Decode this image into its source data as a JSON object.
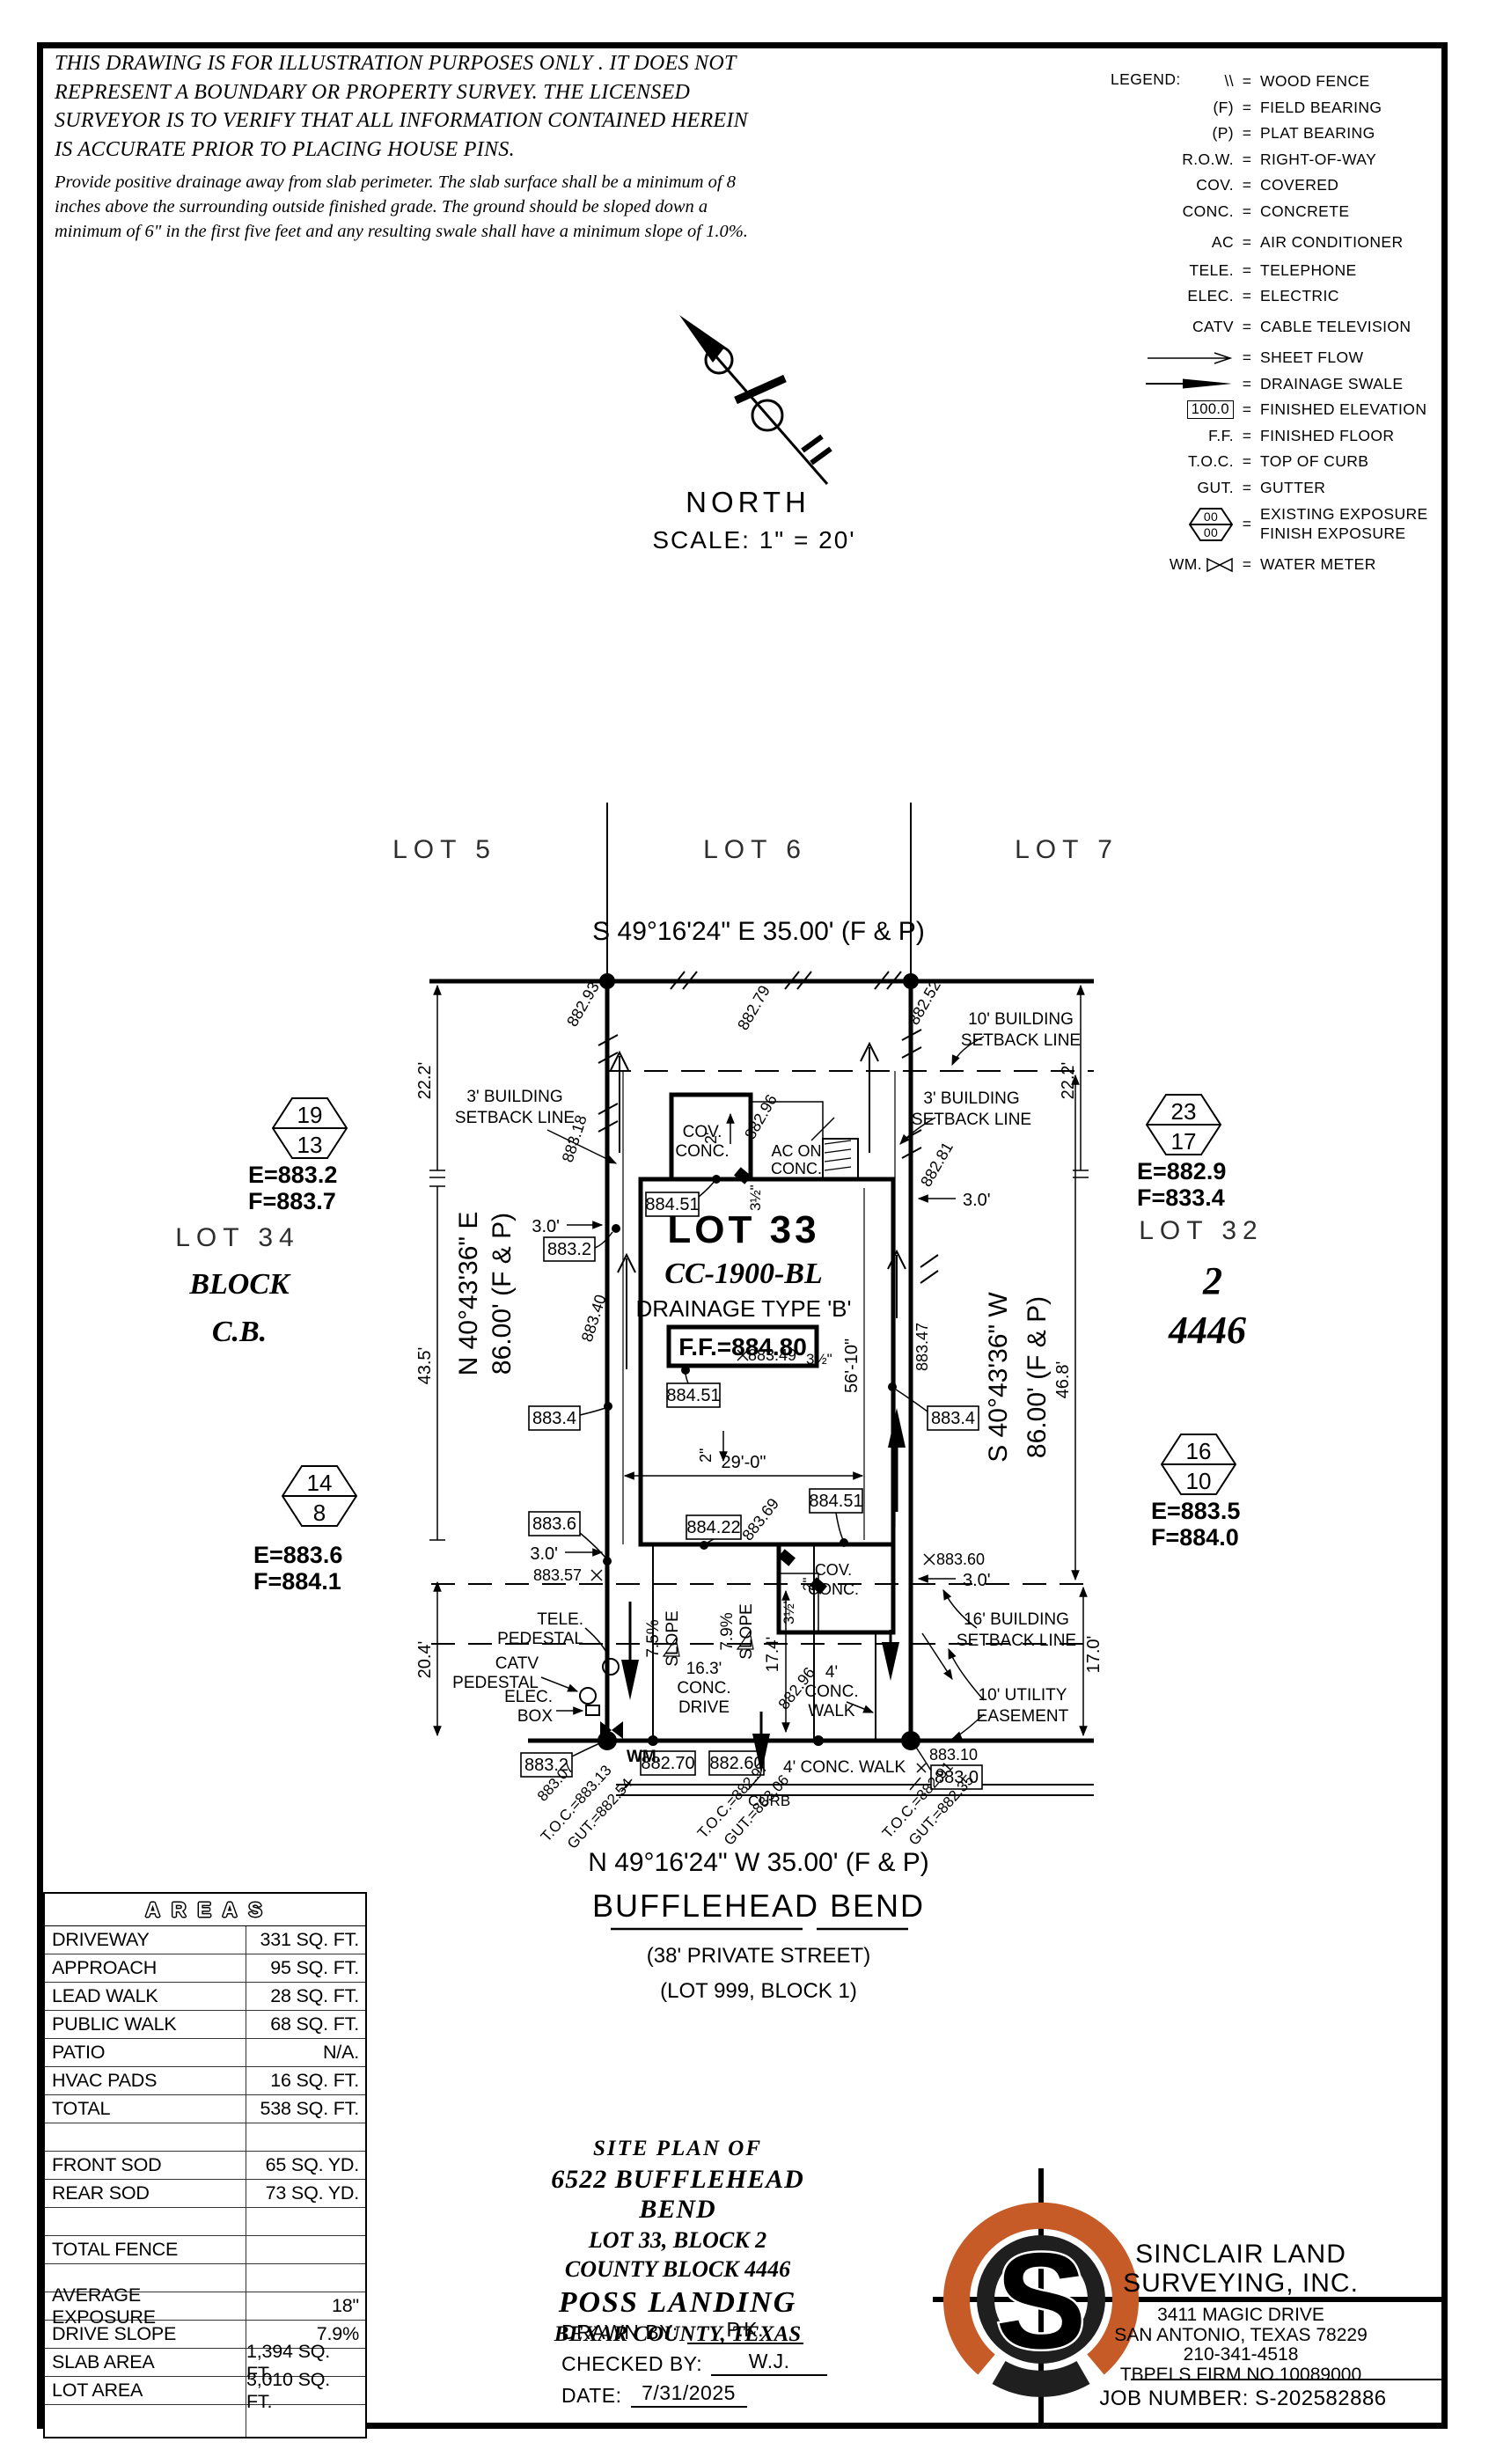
{
  "colors": {
    "ink": "#000000",
    "logo_orange": "#C75B28",
    "logo_dark": "#1f1f1f"
  },
  "disclaimer": {
    "p1": "THIS DRAWING IS FOR ILLUSTRATION PURPOSES ONLY . IT DOES NOT REPRESENT A BOUNDARY OR PROPERTY SURVEY. THE LICENSED SURVEYOR IS TO VERIFY THAT ALL INFORMATION CONTAINED HEREIN IS ACCURATE PRIOR TO PLACING HOUSE PINS.",
    "p2": "Provide positive drainage away from slab perimeter. The slab surface shall be a minimum of 8 inches above the surrounding outside finished grade. The ground should be sloped down a minimum of 6\" in the first five feet and any resulting swale shall have a minimum slope of 1.0%."
  },
  "legend": {
    "title": "LEGEND:",
    "eq": "=",
    "hex_top": "00",
    "hex_bottom": "00",
    "wm_box": "100.0",
    "items": [
      {
        "sym": "\\\\",
        "label": "WOOD FENCE"
      },
      {
        "sym": "(F)",
        "label": "FIELD BEARING"
      },
      {
        "sym": "(P)",
        "label": "PLAT BEARING"
      },
      {
        "sym": "R.O.W.",
        "label": "RIGHT-OF-WAY"
      },
      {
        "sym": "COV.",
        "label": "COVERED"
      },
      {
        "sym": "CONC.",
        "label": "CONCRETE"
      },
      {
        "sym": "AC",
        "label": "AIR CONDITIONER"
      },
      {
        "sym": "TELE.",
        "label": "TELEPHONE"
      },
      {
        "sym": "ELEC.",
        "label": "ELECTRIC"
      },
      {
        "sym": "CATV",
        "label": "CABLE TELEVISION"
      },
      {
        "sym": "sheet-flow-arrow",
        "label": "SHEET FLOW"
      },
      {
        "sym": "drainage-swale-arrow",
        "label": "DRAINAGE SWALE"
      },
      {
        "sym": "100.0",
        "label": "FINISHED ELEVATION"
      },
      {
        "sym": "F.F.",
        "label": "FINISHED FLOOR"
      },
      {
        "sym": "T.O.C.",
        "label": "TOP OF CURB"
      },
      {
        "sym": "GUT.",
        "label": "GUTTER"
      },
      {
        "sym": "exposure-hexagon",
        "label": "EXISTING EXPOSURE",
        "label2": "FINISH EXPOSURE"
      },
      {
        "sym": "WM.",
        "label": "WATER METER"
      }
    ]
  },
  "north": {
    "label": "NORTH",
    "scale": "SCALE: 1\" = 20'"
  },
  "plat": {
    "lots": {
      "lot5": "LOT 5",
      "lot6": "LOT 6",
      "lot7": "LOT 7",
      "lot34": "LOT 34",
      "block": "BLOCK",
      "cb": "C.B.",
      "lot32": "LOT 32",
      "block_num": "2",
      "county_block": "4446"
    },
    "bearings": {
      "top": "S 49°16'24\" E 35.00' (F & P)",
      "bottom": "N 49°16'24\" W 35.00' (F & P)",
      "left1": "N 40°43'36\" E",
      "left2": "86.00' (F & P)",
      "right1": "S 40°43'36\" W",
      "right2": "86.00' (F & P)"
    },
    "street": {
      "name": "BUFFLEHEAD BEND",
      "note1": "(38' PRIVATE STREET)",
      "note2": "(LOT 999, BLOCK 1)",
      "curb": "CURB"
    },
    "house": {
      "lot33": "LOT 33",
      "plan": "CC-1900-BL",
      "drainage": "DRAINAGE TYPE 'B'",
      "ff": "F.F.=884.80"
    },
    "setbacks": {
      "b10a": "10' BUILDING",
      "b10b": "SETBACK LINE",
      "b3a": "3' BUILDING",
      "b3b": "SETBACK LINE",
      "b16a": "16' BUILDING",
      "b16b": "SETBACK LINE",
      "uea": "10' UTILITY",
      "ueb": "EASEMENT"
    },
    "features": {
      "cova": "COV.",
      "covb": "CONC.",
      "aca": "AC ON",
      "acb": "CONC.",
      "drv1": "16.3'",
      "drv2": "CONC.",
      "drv3": "DRIVE",
      "slope75": "7.5%",
      "slope79": "7.9%",
      "slope_word": "SLOPE",
      "walk1": "4'",
      "walk2": "CONC.",
      "walk3": "WALK",
      "walk_bottom": "4' CONC. WALK",
      "tele1": "TELE.",
      "tele2": "PEDESTAL",
      "catv1": "CATV",
      "catv2": "PEDESTAL",
      "elec1": "ELEC.",
      "elec2": "BOX",
      "wm": "WM."
    },
    "dims": {
      "d222": "22.2'",
      "d435": "43.5'",
      "d204": "20.4'",
      "d468": "46.8'",
      "d170": "17.0'",
      "d174": "17.4'",
      "d5610": "56'-10\"",
      "d290": "29'-0\"",
      "d30": "3.0'",
      "d2ft": "2'",
      "d2in": "2\"",
      "d35in": "3½\""
    },
    "spots": {
      "e88293": "882.93",
      "e88279": "882.79",
      "e88252": "882.52",
      "e88318": "883.18",
      "e88296": "882.96",
      "e88281": "882.81",
      "e88340": "883.40",
      "e88347": "883.47",
      "e88369": "883.69",
      "e88357": "883.57",
      "e88360": "883.60",
      "e88349": "883.49",
      "e88310": "883.10",
      "e88307": "883.07"
    },
    "boxes": {
      "v88451": "884.51",
      "v88422": "884.22",
      "v8832": "883.2",
      "v8834": "883.4",
      "v8836": "883.6",
      "v8830": "883.0",
      "v88270": "882.70",
      "v88260": "882.60"
    },
    "toc": {
      "l1": "T.O.C.=883.13",
      "l2": "GUT.=882.54",
      "c1": "T.O.C.=882.97",
      "c2": "GUT.=883.06",
      "r1": "T.O.C.=882.91",
      "r2": "GUT.=882.35"
    },
    "hexes": {
      "tl_top": "19",
      "tl_bot": "13",
      "tl_e": "E=883.2",
      "tl_f": "F=883.7",
      "bl_top": "14",
      "bl_bot": "8",
      "bl_e": "E=883.6",
      "bl_f": "F=884.1",
      "tr_top": "23",
      "tr_bot": "17",
      "tr_e": "E=882.9",
      "tr_f": "F=833.4",
      "br_top": "16",
      "br_bot": "10",
      "br_e": "E=883.5",
      "br_f": "F=884.0"
    }
  },
  "areas": {
    "header": "AREAS",
    "rows": [
      {
        "label": "DRIVEWAY",
        "value": "331 SQ. FT."
      },
      {
        "label": "APPROACH",
        "value": "95 SQ. FT."
      },
      {
        "label": "LEAD WALK",
        "value": "28 SQ. FT."
      },
      {
        "label": "PUBLIC WALK",
        "value": "68 SQ. FT."
      },
      {
        "label": "PATIO",
        "value": "N/A."
      },
      {
        "label": "HVAC PADS",
        "value": "16 SQ. FT."
      },
      {
        "label": "TOTAL",
        "value": "538 SQ. FT."
      },
      {
        "label": "",
        "value": ""
      },
      {
        "label": "FRONT SOD",
        "value": "65 SQ. YD."
      },
      {
        "label": "REAR SOD",
        "value": "73 SQ. YD."
      },
      {
        "label": "",
        "value": ""
      },
      {
        "label": "TOTAL FENCE",
        "value": "85 LN. FT."
      },
      {
        "label": "",
        "value": ""
      },
      {
        "label": "AVERAGE EXPOSURE",
        "value": "18\""
      },
      {
        "label": "DRIVE SLOPE",
        "value": "7.9%"
      },
      {
        "label": "SLAB AREA",
        "value": "1,394 SQ. FT."
      },
      {
        "label": "LOT AREA",
        "value": "3,010 SQ. FT."
      },
      {
        "label": "",
        "value": ""
      }
    ]
  },
  "titleblock": {
    "l1": "SITE PLAN OF",
    "l2": "6522 BUFFLEHEAD BEND",
    "l3": "LOT 33, BLOCK 2",
    "l4": "COUNTY BLOCK 4446",
    "l5": "POSS LANDING",
    "l6": "BEXAR COUNTY, TEXAS",
    "drawn_label": "DRAWN BY:",
    "drawn_value": "P.K.",
    "checked_label": "CHECKED BY:",
    "checked_value": "W.J.",
    "date_label": "DATE:",
    "date_value": "7/31/2025"
  },
  "surveyor": {
    "name1": "SINCLAIR LAND",
    "name2": "SURVEYING, INC.",
    "addr1": "3411 MAGIC DRIVE",
    "addr2": "SAN ANTONIO, TEXAS 78229",
    "phone": "210-341-4518",
    "firm": "TBPELS FIRM NO.10089000",
    "job": "JOB NUMBER: S-202582886",
    "logo_letter": "S"
  }
}
